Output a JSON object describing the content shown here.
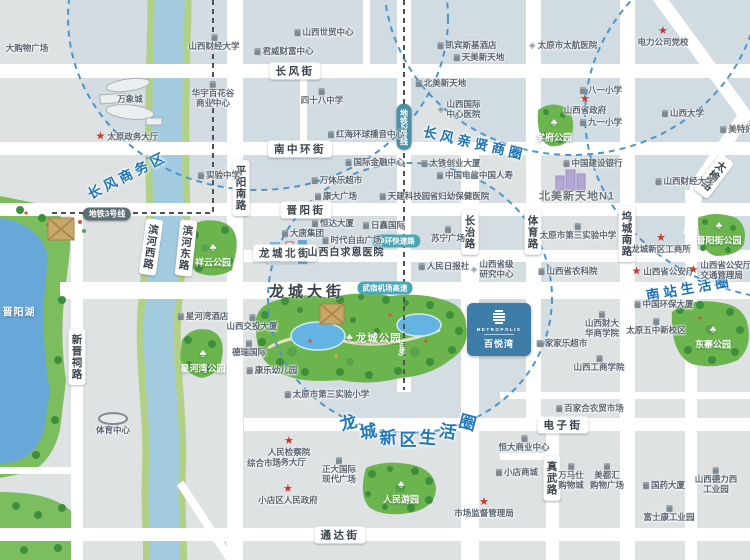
{
  "colors": {
    "accent_blue": "#1d73b4",
    "road_white": "#ffffff",
    "park_green": "#6cb54e",
    "river_blue": "#a3cbe0",
    "lake_blue": "#68a8d8",
    "circle_dash": "#4a96cc",
    "star_red": "#c43b2d",
    "logo_bg": "#3d7da8",
    "metro_pill": "#5d6e72",
    "expwy_pill": "#4ba6b6"
  },
  "logo_card": {
    "en": "METROPOLIS",
    "zh": "百悦湾"
  },
  "districts": [
    {
      "label": "长风商务区",
      "x": 127,
      "y": 174,
      "rot": -27
    },
    {
      "label": "长风亲贤商圈",
      "x": 475,
      "y": 142,
      "rot": 13
    },
    {
      "label": "南站生活圈",
      "x": 689,
      "y": 287,
      "rot": -10
    }
  ],
  "district_arc": {
    "label": "龙城新区生活圈",
    "chars": [
      {
        "c": "龙",
        "x": 348,
        "y": 421,
        "r": -15
      },
      {
        "c": "城",
        "x": 368,
        "y": 430,
        "r": -10
      },
      {
        "c": "新",
        "x": 388,
        "y": 436,
        "r": -5
      },
      {
        "c": "区",
        "x": 408,
        "y": 438,
        "r": 0
      },
      {
        "c": "生",
        "x": 428,
        "y": 436,
        "r": 5
      },
      {
        "c": "活",
        "x": 448,
        "y": 430,
        "r": 10
      },
      {
        "c": "圈",
        "x": 468,
        "y": 421,
        "r": 15
      }
    ]
  },
  "road_pills_h": [
    {
      "label": "长风街",
      "x": 295,
      "y": 71
    },
    {
      "label": "南中环街",
      "x": 300,
      "y": 149
    },
    {
      "label": "晋阳街",
      "x": 306,
      "y": 210
    },
    {
      "label": "龙城北街",
      "x": 285,
      "y": 253
    },
    {
      "label": "电子街",
      "x": 563,
      "y": 425
    },
    {
      "label": "通达街",
      "x": 340,
      "y": 535
    }
  ],
  "road_pills_v": [
    {
      "label": "平阳南路",
      "x": 241,
      "y": 188,
      "rot": 0
    },
    {
      "label": "滨河西路",
      "x": 151,
      "y": 247,
      "rot": 8
    },
    {
      "label": "滨河东路",
      "x": 186,
      "y": 248,
      "rot": 6
    },
    {
      "label": "新晋祠路",
      "x": 77,
      "y": 357,
      "rot": 0
    },
    {
      "label": "长治路",
      "x": 470,
      "y": 232,
      "rot": 0
    },
    {
      "label": "体育路",
      "x": 533,
      "y": 232,
      "rot": 0
    },
    {
      "label": "坞城南路",
      "x": 627,
      "y": 234,
      "rot": 0
    },
    {
      "label": "真武路",
      "x": 552,
      "y": 478,
      "rot": 0
    },
    {
      "label": "太榆路",
      "x": 714,
      "y": 176,
      "rot": 37
    }
  ],
  "main_road_label": {
    "label": "龙城大街",
    "x": 307,
    "y": 291
  },
  "metro_pills": [
    {
      "label": "地铁3号线",
      "x": 107,
      "y": 214,
      "vert": false
    },
    {
      "label": "地铁2号线",
      "x": 404,
      "y": 127,
      "vert": true
    }
  ],
  "expwy_pills": [
    {
      "label": "中环快速路",
      "x": 396,
      "y": 241
    },
    {
      "label": "武宿机场高速",
      "x": 385,
      "y": 288
    }
  ],
  "park_note": "(在建)",
  "parks": [
    {
      "label": "祥云公园",
      "x": 213,
      "y": 256,
      "mode": "col"
    },
    {
      "label": "星河湾公园",
      "x": 203,
      "y": 362,
      "mode": "col"
    },
    {
      "label": "学府公园",
      "x": 554,
      "y": 131,
      "mode": "col"
    },
    {
      "label": "晋阳街公园",
      "x": 719,
      "y": 234,
      "mode": "col"
    },
    {
      "label": "东寨公园",
      "x": 713,
      "y": 338,
      "mode": "col"
    },
    {
      "label": "龙城公园",
      "x": 374,
      "y": 338,
      "mode": "row",
      "big": true
    },
    {
      "label": "人民游园",
      "x": 401,
      "y": 493,
      "mode": "col"
    }
  ],
  "lake_label": {
    "label": "晋阳湖",
    "x": 19,
    "y": 311
  },
  "pois": [
    {
      "lines": [
        "大购物广场"
      ],
      "x": 27,
      "y": 49,
      "icon": "none",
      "ipos": "l"
    },
    {
      "lines": [
        "山西财经大学"
      ],
      "x": 214,
      "y": 43,
      "icon": "b",
      "ipos": "t"
    },
    {
      "lines": [
        "万象城"
      ],
      "x": 130,
      "y": 100,
      "icon": "none",
      "ipos": "l"
    },
    {
      "lines": [
        "华宇百花谷",
        "商业中心"
      ],
      "x": 213,
      "y": 95,
      "icon": "b",
      "ipos": "t"
    },
    {
      "lines": [
        "太原政务大厅"
      ],
      "x": 127,
      "y": 137,
      "icon": "s",
      "ipos": "l"
    },
    {
      "lines": [
        "实验中学"
      ],
      "x": 219,
      "y": 176,
      "icon": "b",
      "ipos": "l"
    },
    {
      "lines": [
        "君威财富中心"
      ],
      "x": 284,
      "y": 52,
      "icon": "b",
      "ipos": "l"
    },
    {
      "lines": [
        "山西世贸中心"
      ],
      "x": 324,
      "y": 33,
      "icon": "b",
      "ipos": "l"
    },
    {
      "lines": [
        "四十八中学"
      ],
      "x": 322,
      "y": 97,
      "icon": "b",
      "ipos": "t"
    },
    {
      "lines": [
        "红海环球播音中心"
      ],
      "x": 366,
      "y": 135,
      "icon": "b",
      "ipos": "l"
    },
    {
      "lines": [
        "国际金融中心"
      ],
      "x": 375,
      "y": 163,
      "icon": "b",
      "ipos": "l"
    },
    {
      "lines": [
        "万体乐超市"
      ],
      "x": 337,
      "y": 181,
      "icon": "b",
      "ipos": "l"
    },
    {
      "lines": [
        "太铁创业大厦"
      ],
      "x": 451,
      "y": 164,
      "icon": "b",
      "ipos": "l"
    },
    {
      "lines": [
        "中国电信"
      ],
      "x": 458,
      "y": 176,
      "icon": "b",
      "ipos": "l"
    },
    {
      "lines": [
        "中国人寿"
      ],
      "x": 492,
      "y": 176,
      "icon": "b",
      "ipos": "l"
    },
    {
      "lines": [
        "凯宾斯基酒店"
      ],
      "x": 467,
      "y": 46,
      "icon": "b",
      "ipos": "l"
    },
    {
      "lines": [
        "天美新天地"
      ],
      "x": 479,
      "y": 58,
      "icon": "b",
      "ipos": "l"
    },
    {
      "lines": [
        "北美新天地"
      ],
      "x": 441,
      "y": 84,
      "icon": "b",
      "ipos": "l"
    },
    {
      "lines": [
        "山西国际",
        "中心医院"
      ],
      "x": 459,
      "y": 110,
      "icon": "h",
      "ipos": "l"
    },
    {
      "lines": [
        "太原市太航医院"
      ],
      "x": 563,
      "y": 46,
      "icon": "h",
      "ipos": "l"
    },
    {
      "lines": [
        "电力公司党校"
      ],
      "x": 663,
      "y": 37,
      "icon": "s",
      "ipos": "t"
    },
    {
      "lines": [
        "八一小学"
      ],
      "x": 601,
      "y": 91,
      "icon": "b",
      "ipos": "l"
    },
    {
      "lines": [
        "山西省政府"
      ],
      "x": 585,
      "y": 105,
      "icon": "s",
      "ipos": "t"
    },
    {
      "lines": [
        "九一小学"
      ],
      "x": 601,
      "y": 123,
      "icon": "b",
      "ipos": "l"
    },
    {
      "lines": [
        "山西大学"
      ],
      "x": 683,
      "y": 114,
      "icon": "b",
      "ipos": "l"
    },
    {
      "lines": [
        "美特好"
      ],
      "x": 737,
      "y": 130,
      "icon": "b",
      "ipos": "l"
    },
    {
      "lines": [
        "中国建设银行"
      ],
      "x": 593,
      "y": 164,
      "icon": "b",
      "ipos": "l"
    },
    {
      "lines": [
        "北美新天地N1"
      ],
      "x": 577,
      "y": 197,
      "icon": "none",
      "ipos": "l",
      "cls": "hdr"
    },
    {
      "lines": [
        "山西财经大学"
      ],
      "x": 685,
      "y": 182,
      "icon": "b",
      "ipos": "l"
    },
    {
      "lines": [
        "康大广场"
      ],
      "x": 336,
      "y": 197,
      "icon": "b",
      "ipos": "l"
    },
    {
      "lines": [
        "天建科技园"
      ],
      "x": 405,
      "y": 197,
      "icon": "b",
      "ipos": "l"
    },
    {
      "lines": [
        "省妇幼保健医院"
      ],
      "x": 455,
      "y": 197,
      "icon": "h",
      "ipos": "l"
    },
    {
      "lines": [
        "恒达大厦"
      ],
      "x": 333,
      "y": 224,
      "icon": "b",
      "ipos": "l"
    },
    {
      "lines": [
        "日鑫国际"
      ],
      "x": 384,
      "y": 226,
      "icon": "b",
      "ipos": "l"
    },
    {
      "lines": [
        "大唐集团"
      ],
      "x": 303,
      "y": 234,
      "icon": "b",
      "ipos": "l"
    },
    {
      "lines": [
        "时代自由广场"
      ],
      "x": 352,
      "y": 241,
      "icon": "b",
      "ipos": "l"
    },
    {
      "lines": [
        "山西白求恩医院"
      ],
      "x": 346,
      "y": 253,
      "icon": "none",
      "ipos": "l",
      "cls": "med"
    },
    {
      "lines": [
        "苏宁广场"
      ],
      "x": 448,
      "y": 235,
      "icon": "b",
      "ipos": "t"
    },
    {
      "lines": [
        "人民日报社"
      ],
      "x": 444,
      "y": 267,
      "icon": "b",
      "ipos": "l"
    },
    {
      "lines": [
        "山西省级",
        "研究中心"
      ],
      "x": 492,
      "y": 270,
      "icon": "h",
      "ipos": "l"
    },
    {
      "lines": [
        "山西省农科院"
      ],
      "x": 568,
      "y": 272,
      "icon": "b",
      "ipos": "l"
    },
    {
      "lines": [
        "太原市第三实验中学"
      ],
      "x": 578,
      "y": 232,
      "icon": "b",
      "ipos": "t"
    },
    {
      "lines": [
        "龙城新区工商所"
      ],
      "x": 661,
      "y": 244,
      "icon": "s",
      "ipos": "t"
    },
    {
      "lines": [
        "山西省公安厅"
      ],
      "x": 663,
      "y": 272,
      "icon": "s",
      "ipos": "l"
    },
    {
      "lines": [
        "山西省公安厅",
        "交通管理局"
      ],
      "x": 720,
      "y": 271,
      "icon": "s",
      "ipos": "l"
    },
    {
      "lines": [
        "中国环保大厦"
      ],
      "x": 664,
      "y": 305,
      "icon": "b",
      "ipos": "l"
    },
    {
      "lines": [
        "太原五中新校区"
      ],
      "x": 656,
      "y": 327,
      "icon": "b",
      "ipos": "t"
    },
    {
      "lines": [
        "山西财大",
        "华商学院"
      ],
      "x": 602,
      "y": 325,
      "icon": "b",
      "ipos": "t"
    },
    {
      "lines": [
        "家家乐超市"
      ],
      "x": 562,
      "y": 344,
      "icon": "b",
      "ipos": "l"
    },
    {
      "lines": [
        "山西工商学院"
      ],
      "x": 599,
      "y": 364,
      "icon": "b",
      "ipos": "t"
    },
    {
      "lines": [
        "山西交投大厦"
      ],
      "x": 252,
      "y": 323,
      "icon": "b",
      "ipos": "t"
    },
    {
      "lines": [
        "德瑞国际"
      ],
      "x": 249,
      "y": 349,
      "icon": "b",
      "ipos": "t"
    },
    {
      "lines": [
        "康乐幼儿园"
      ],
      "x": 272,
      "y": 371,
      "icon": "b",
      "ipos": "l"
    },
    {
      "lines": [
        "星河湾酒店"
      ],
      "x": 203,
      "y": 317,
      "icon": "b",
      "ipos": "l"
    },
    {
      "lines": [
        "太原市第三实验小学"
      ],
      "x": 327,
      "y": 395,
      "icon": "b",
      "ipos": "l"
    },
    {
      "lines": [
        "人民检察院",
        "服务大厅"
      ],
      "x": 289,
      "y": 452,
      "icon": "s",
      "ipos": "t"
    },
    {
      "lines": [
        "综合市场"
      ],
      "x": 264,
      "y": 464,
      "icon": "none",
      "ipos": "l"
    },
    {
      "lines": [
        "正大国际",
        "现代广场"
      ],
      "x": 339,
      "y": 471,
      "icon": "b",
      "ipos": "t"
    },
    {
      "lines": [
        "小店区人民政府"
      ],
      "x": 288,
      "y": 495,
      "icon": "s",
      "ipos": "t"
    },
    {
      "lines": [
        "市场监督管理局"
      ],
      "x": 484,
      "y": 508,
      "icon": "s",
      "ipos": "t"
    },
    {
      "lines": [
        "百家合农贸市场"
      ],
      "x": 590,
      "y": 409,
      "icon": "b",
      "ipos": "l"
    },
    {
      "lines": [
        "恒大商业中心"
      ],
      "x": 524,
      "y": 444,
      "icon": "b",
      "ipos": "t"
    },
    {
      "lines": [
        "小店商城"
      ],
      "x": 517,
      "y": 473,
      "icon": "b",
      "ipos": "l"
    },
    {
      "lines": [
        "万马仕",
        "购物城"
      ],
      "x": 571,
      "y": 477,
      "icon": "b",
      "ipos": "t"
    },
    {
      "lines": [
        "美都汇",
        "购物广场"
      ],
      "x": 607,
      "y": 477,
      "icon": "b",
      "ipos": "t"
    },
    {
      "lines": [
        "国药大厦"
      ],
      "x": 664,
      "y": 486,
      "icon": "b",
      "ipos": "l"
    },
    {
      "lines": [
        "山西德力西",
        "工业园"
      ],
      "x": 716,
      "y": 481,
      "icon": "b",
      "ipos": "t"
    },
    {
      "lines": [
        "富士康工业园"
      ],
      "x": 669,
      "y": 514,
      "icon": "b",
      "ipos": "t"
    },
    {
      "lines": [
        "体育中心"
      ],
      "x": 113,
      "y": 424,
      "icon": "stad",
      "ipos": "t"
    }
  ]
}
